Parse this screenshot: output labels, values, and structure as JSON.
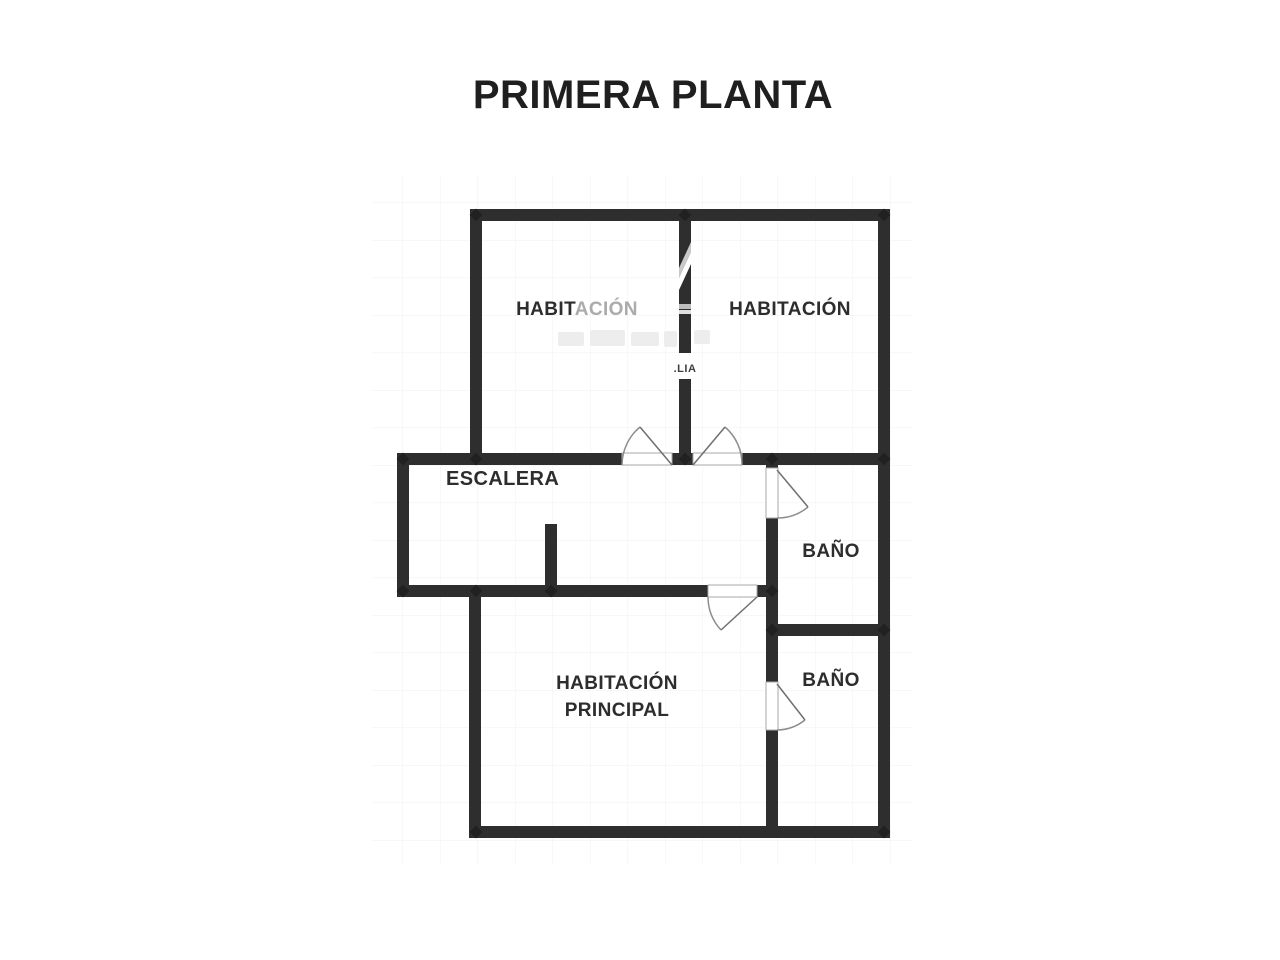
{
  "page": {
    "title": "PRIMERA PLANTA",
    "background": "#ffffff"
  },
  "colors": {
    "wall": "#2e2e2e",
    "label": "#2d2d2d",
    "label_watermarked": "#ababab",
    "door_arc": "#8d8d8d",
    "grid": "#f2f2f2",
    "watermark_gray": "#c9c9c9"
  },
  "floor_plan": {
    "rooms": [
      {
        "id": "habitacion-1",
        "label": "HABITACIÓN",
        "label_parts": [
          "HABIT",
          "ACIÓN"
        ]
      },
      {
        "id": "habitacion-2",
        "label": "HABITACIÓN"
      },
      {
        "id": "escalera",
        "label": "ESCALERA"
      },
      {
        "id": "bano-1",
        "label": "BAÑO"
      },
      {
        "id": "bano-2",
        "label": "BAÑO"
      },
      {
        "id": "habitacion-principal",
        "label_line1": "HABITACIÓN",
        "label_line2": "PRINCIPAL"
      }
    ],
    "watermark": {
      "fragment": ".LIA"
    }
  }
}
